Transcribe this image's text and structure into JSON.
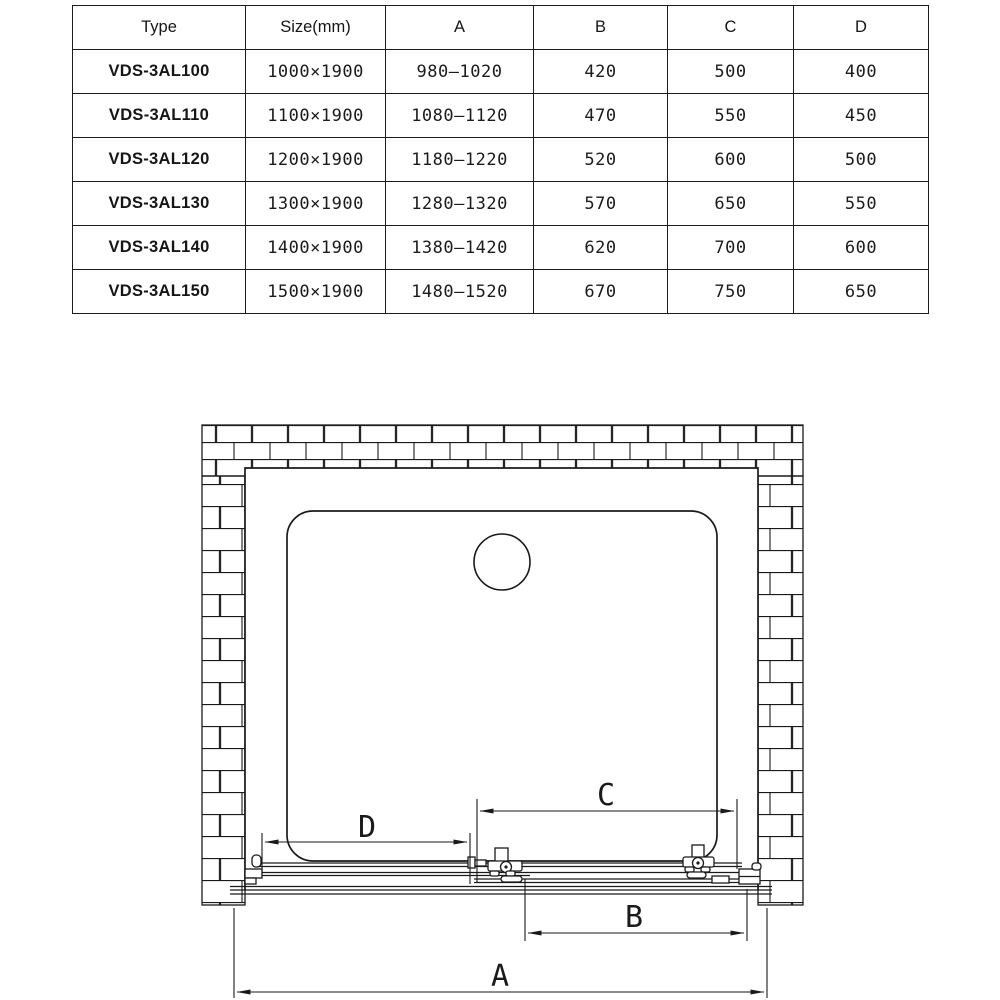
{
  "page": {
    "background": "#ffffff",
    "line_color": "#1a1a1a"
  },
  "table": {
    "headers": [
      "Type",
      "Size(mm)",
      "A",
      "B",
      "C",
      "D"
    ],
    "rows": [
      [
        "VDS-3AL100",
        "1000×1900",
        "980–1020",
        "420",
        "500",
        "400"
      ],
      [
        "VDS-3AL110",
        "1100×1900",
        "1080–1120",
        "470",
        "550",
        "450"
      ],
      [
        "VDS-3AL120",
        "1200×1900",
        "1180–1220",
        "520",
        "600",
        "500"
      ],
      [
        "VDS-3AL130",
        "1300×1900",
        "1280–1320",
        "570",
        "650",
        "550"
      ],
      [
        "VDS-3AL140",
        "1400×1900",
        "1380–1420",
        "620",
        "700",
        "600"
      ],
      [
        "VDS-3AL150",
        "1500×1900",
        "1480–1520",
        "670",
        "750",
        "650"
      ]
    ]
  },
  "diagram": {
    "labels": {
      "a": "A",
      "b": "B",
      "c": "C",
      "d": "D"
    }
  }
}
